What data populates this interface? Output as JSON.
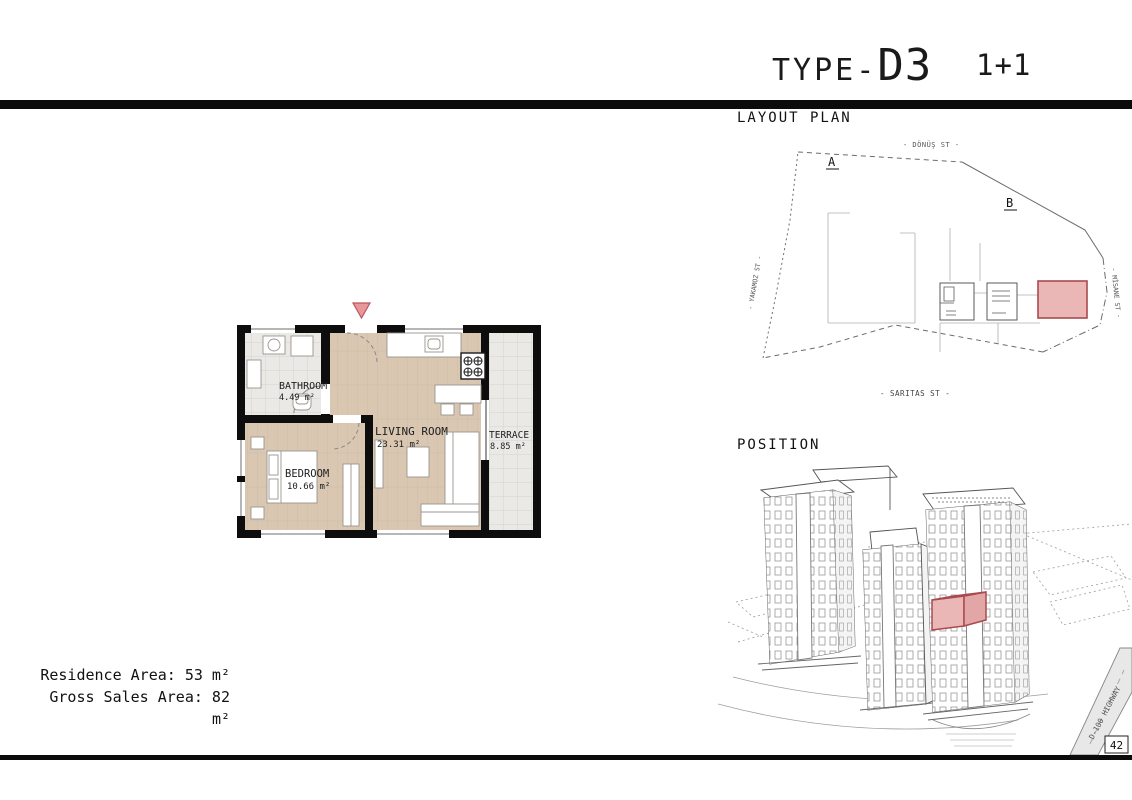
{
  "header": {
    "title_prefix": "TYPE-",
    "title_code": "D3",
    "unit_type": "1+1"
  },
  "floor_plan": {
    "rooms": [
      {
        "name": "BATHROOM",
        "area": "4.49 m²"
      },
      {
        "name": "LIVING ROOM",
        "area": "23.31 m²"
      },
      {
        "name": "BEDROOM",
        "area": "10.66 m²"
      },
      {
        "name": "TERRACE",
        "area": "8.85 m²"
      }
    ]
  },
  "summary": {
    "residence_area": "Residence Area: 53 m²",
    "gross_sales_area": "Gross Sales Area: 82 m²"
  },
  "layout_plan": {
    "heading": "LAYOUT PLAN",
    "street_top": "- DÖNÜŞ ST -",
    "street_left": "- YAKAMOZ ST -",
    "street_right": "- MİSANE ST -",
    "street_bottom": "- SARITAS ST -",
    "marker_a": "A",
    "marker_b": "B"
  },
  "position": {
    "heading": "POSITION",
    "highway_label": "D-100 HIGHWAY",
    "road_badge": "42"
  },
  "colors": {
    "highlight_fill": "#eab6b6",
    "highlight_stroke": "#a94a4f",
    "entry_marker": "#e8979b",
    "wood": "#d9c7b2",
    "tile": "#ebe9e6",
    "wall": "#0d0d0d"
  }
}
